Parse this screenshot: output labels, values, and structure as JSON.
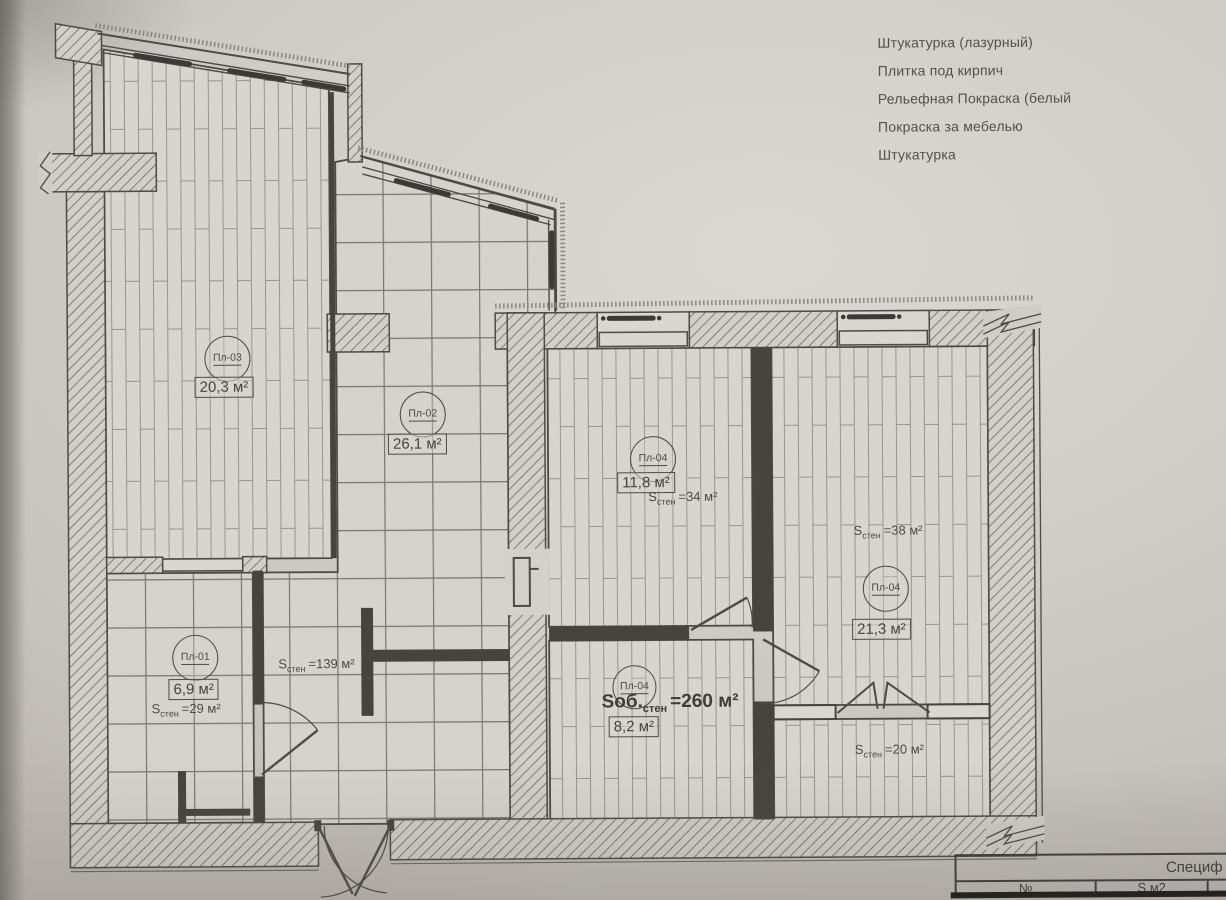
{
  "legend": {
    "items": [
      "Штукатурка (лазурный)",
      "Плитка под кирпич",
      "Рельефная Покраска (белый",
      "Покраска за мебелью",
      "Штукатурка"
    ]
  },
  "rooms": [
    {
      "code": "Пл-03",
      "area": "20,3 м²"
    },
    {
      "code": "Пл-02",
      "area": "26,1 м²"
    },
    {
      "code": "Пл-04",
      "area": "11,8 м²",
      "s_label": "S",
      "s_sub": "стен",
      "s_value": "=34 м²"
    },
    {
      "code": "Пл-04",
      "area": "21,3 м²",
      "s_label": "S",
      "s_sub": "стен",
      "s_value": "=38 м²"
    },
    {
      "code": "Пл-01",
      "area": "6,9 м²",
      "s_label": "S",
      "s_sub": "стен",
      "s_value": "=29 м²"
    },
    {
      "code": "Пл-04",
      "area": "8,2 м²"
    }
  ],
  "annotations": {
    "hall": {
      "s_label": "S",
      "s_sub": "стен",
      "s_value": "=139 м²"
    },
    "total": {
      "s_label": "Sоб.",
      "s_sub": "стен",
      "s_value": "=260 м²"
    },
    "balcony": {
      "s_label": "S",
      "s_sub": "стен",
      "s_value": "=20 м²"
    }
  },
  "spec_table": {
    "title": "Специф",
    "columns": [
      "№",
      "S,м2"
    ]
  },
  "colors": {
    "ink": "#4e4a45",
    "paper": "#cdc9c4"
  }
}
